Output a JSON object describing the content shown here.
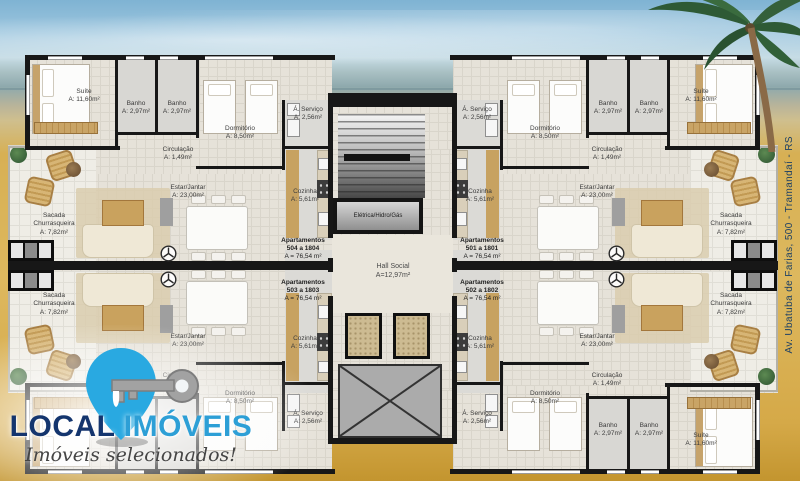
{
  "address": {
    "text": "Av. Ubatuba de Farias, 500 - Tramandaí - RS",
    "color": "#1d4065"
  },
  "logo": {
    "title_local": "LOCAL",
    "title_imoveis": "IMÓVEIS",
    "tagline": "Imóveis selecionados!",
    "pin_color": "#29a9e1",
    "key_color": "#a2a2a2",
    "local_color": "#14356e",
    "imoveis_color": "#2d9fd6"
  },
  "plan": {
    "utility_room": "Elétrica/Hidro/Gás",
    "hall": {
      "label": "Hall Social",
      "area": "A=12,97m²"
    },
    "units": [
      {
        "lines": [
          "Apartamentos",
          "504 a 1804",
          "A = 76,54 m²"
        ],
        "x": 303,
        "y": 237
      },
      {
        "lines": [
          "Apartamentos",
          "501 a 1801",
          "A = 76,54 m²"
        ],
        "x": 482,
        "y": 237
      },
      {
        "lines": [
          "Apartamentos",
          "503 a 1803",
          "A = 76,54 m²"
        ],
        "x": 303,
        "y": 279
      },
      {
        "lines": [
          "Apartamentos",
          "502 a 1802",
          "A = 76,54 m²"
        ],
        "x": 482,
        "y": 279
      }
    ],
    "rooms": [
      {
        "lines": [
          "Suíte",
          "A: 11,60m²"
        ],
        "x": 84,
        "y": 88
      },
      {
        "lines": [
          "Banho",
          "A: 2,97m²"
        ],
        "x": 136,
        "y": 100
      },
      {
        "lines": [
          "Banho",
          "A: 2,97m²"
        ],
        "x": 177,
        "y": 100
      },
      {
        "lines": [
          "Dormitório",
          "A: 8,50m²"
        ],
        "x": 240,
        "y": 125
      },
      {
        "lines": [
          "Á. Serviço",
          "A: 2,56m²"
        ],
        "x": 308,
        "y": 106
      },
      {
        "lines": [
          "Circulação",
          "A: 1,49m²"
        ],
        "x": 178,
        "y": 146
      },
      {
        "lines": [
          "Estar/Jantar",
          "A: 23,00m²"
        ],
        "x": 188,
        "y": 184
      },
      {
        "lines": [
          "Cozinha",
          "A: 5,61m²"
        ],
        "x": 305,
        "y": 188
      },
      {
        "lines": [
          "Sacada",
          "Churrasqueira",
          "A: 7,82m²"
        ],
        "x": 54,
        "y": 212
      },
      {
        "lines": [
          "Á. Serviço",
          "A: 2,56m²"
        ],
        "x": 477,
        "y": 106
      },
      {
        "lines": [
          "Dormitório",
          "A: 8,50m²"
        ],
        "x": 545,
        "y": 125
      },
      {
        "lines": [
          "Banho",
          "A: 2,97m²"
        ],
        "x": 608,
        "y": 100
      },
      {
        "lines": [
          "Banho",
          "A: 2,97m²"
        ],
        "x": 649,
        "y": 100
      },
      {
        "lines": [
          "Suíte",
          "A: 11,60m²"
        ],
        "x": 701,
        "y": 88
      },
      {
        "lines": [
          "Circulação",
          "A: 1,49m²"
        ],
        "x": 607,
        "y": 146
      },
      {
        "lines": [
          "Cozinha",
          "A: 5,61m²"
        ],
        "x": 480,
        "y": 188
      },
      {
        "lines": [
          "Estar/Jantar",
          "A: 23,00m²"
        ],
        "x": 597,
        "y": 184
      },
      {
        "lines": [
          "Sacada",
          "Churrasqueira",
          "A: 7,82m²"
        ],
        "x": 731,
        "y": 212
      },
      {
        "lines": [
          "Sacada",
          "Churrasqueira",
          "A: 7,82m²"
        ],
        "x": 54,
        "y": 292
      },
      {
        "lines": [
          "Estar/Jantar",
          "A: 23,00m²"
        ],
        "x": 188,
        "y": 333
      },
      {
        "lines": [
          "Cozinha",
          "A: 5,61m²"
        ],
        "x": 305,
        "y": 335
      },
      {
        "lines": [
          "Circulação",
          "A: 1,49m²"
        ],
        "x": 178,
        "y": 372
      },
      {
        "lines": [
          "Dormitório",
          "A: 8,50m²"
        ],
        "x": 240,
        "y": 390
      },
      {
        "lines": [
          "Á. Serviço",
          "A: 2,56m²"
        ],
        "x": 308,
        "y": 410
      },
      {
        "lines": [
          "Sacada",
          "Churrasqueira",
          "A: 7,82m²"
        ],
        "x": 731,
        "y": 292
      },
      {
        "lines": [
          "Estar/Jantar",
          "A: 23,00m²"
        ],
        "x": 597,
        "y": 333
      },
      {
        "lines": [
          "Cozinha",
          "A: 5,61m²"
        ],
        "x": 480,
        "y": 335
      },
      {
        "lines": [
          "Circulação",
          "A: 1,49m²"
        ],
        "x": 607,
        "y": 372
      },
      {
        "lines": [
          "Dormitório",
          "A: 8,50m²"
        ],
        "x": 545,
        "y": 390
      },
      {
        "lines": [
          "Á. Serviço",
          "A: 2,56m²"
        ],
        "x": 477,
        "y": 410
      },
      {
        "lines": [
          "Banho",
          "A: 2,97m²"
        ],
        "x": 608,
        "y": 422
      },
      {
        "lines": [
          "Banho",
          "A: 2,97m²"
        ],
        "x": 649,
        "y": 422
      },
      {
        "lines": [
          "Suíte",
          "A: 11,60m²"
        ],
        "x": 701,
        "y": 432
      }
    ]
  }
}
